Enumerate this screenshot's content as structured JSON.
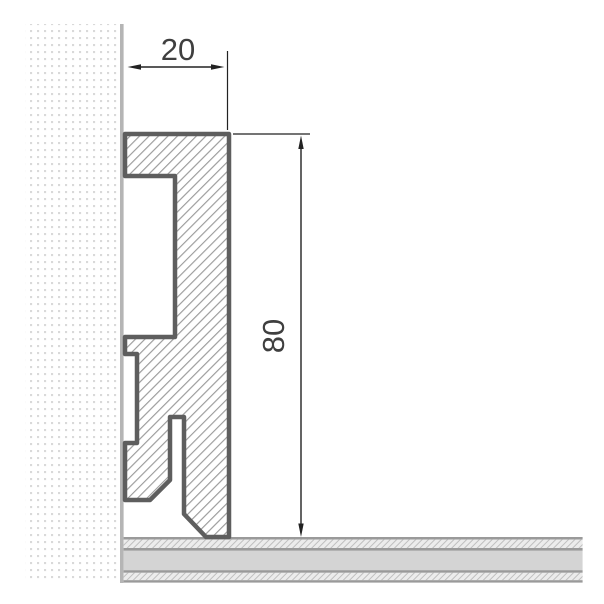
{
  "drawing": {
    "kind": "skirting-board-profile-cross-section",
    "dimensions": {
      "width_mm": "20",
      "height_mm": "80"
    }
  },
  "colors": {
    "background": "#ffffff",
    "profile_outline": "#5e5e5e",
    "profile_hatch_line": "#9b9b9b",
    "wall_dot": "#d9d9d9",
    "wall_surface_line": "#b5b5b5",
    "floor_plain_fill": "#d4d4d4",
    "floor_hatch_bg": "#ececec",
    "floor_hatch_line": "#bfbfbf",
    "floor_line": "#9a9a9a",
    "dimension_line": "#222222",
    "dimension_text": "#3f3f3f"
  }
}
